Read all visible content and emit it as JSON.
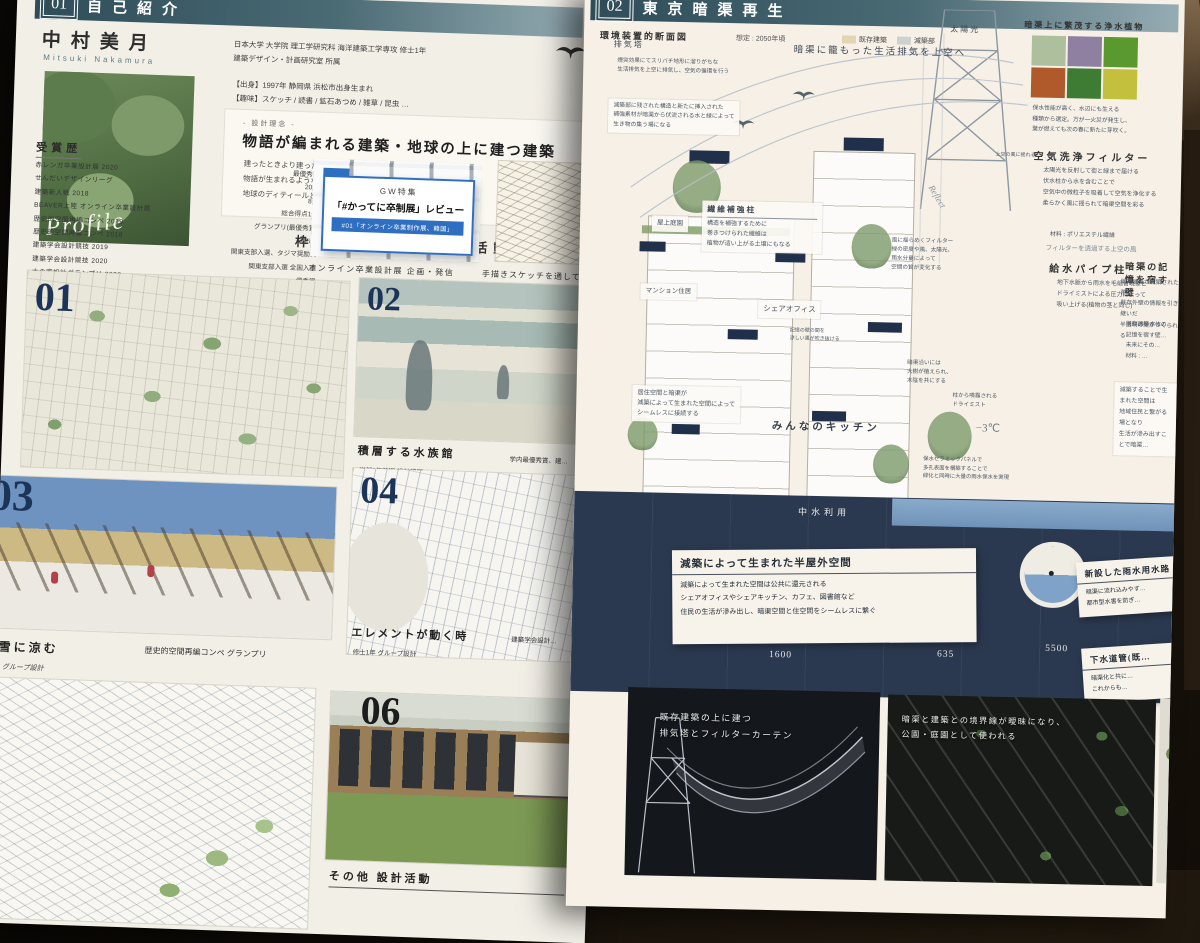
{
  "colors": {
    "header_teal": "#3a5863",
    "accent_blue": "#2f6fc2",
    "navy": "#2b3950",
    "paper": "#f2efe7",
    "paper_pink": "#f7f0e7"
  },
  "left_board": {
    "header": {
      "num": "01",
      "title": "自己紹介"
    },
    "profile": {
      "name": "中村美月",
      "romaji": "Mitsuki Nakamura",
      "photo_script": "Profile",
      "edu1": "日本大学 大学院 理工学研究科 海洋建築工学専攻 修士1年",
      "edu2": "建築デザイン・計画研究室 所属",
      "origin": "【出身】1997年 静岡県 浜松市出身生まれ",
      "hobby": "【趣味】スケッチ / 読書 / 鉱石あつめ / 雑草 / 昆虫 …"
    },
    "philosophy": {
      "tag": "- 設計理念 -",
      "title": "物語が編まれる建築・地球の上に建つ建築",
      "body": "建ったときより建ったあと、長く人々に愛され、\n物語が生まれるような建築をつくりたい。\n地球のディティールとしてたち現れる建築をつくりたい。"
    },
    "activities_heading": "枠に囚われない 設計活動",
    "awards": {
      "title": "受賞歴",
      "rows": [
        {
          "name": "赤レンガ卒業設計展 2020",
          "result": "最優秀賞"
        },
        {
          "name": "せんだいデザインリーグ",
          "result": "20選"
        },
        {
          "name": "建築新人戦 2018",
          "result": "8選"
        },
        {
          "name": "BEAVER上陸 オンライン卒業設計展",
          "result": "総合得点1位"
        },
        {
          "name": "歴史的空間再編コンペ 2019",
          "result": "グランプリ(最優秀賞)"
        },
        {
          "name": "歴史的空間再編コンペ 2018",
          "result": "第5位"
        },
        {
          "name": "建築学会設計競技 2019",
          "result": "関東支部入選、タジマ奨励賞"
        },
        {
          "name": "建築学会設計競技 2020",
          "result": "関東支部入選 全国入選"
        },
        {
          "name": "木の家設計グランプリ 2020",
          "result": "優秀賞"
        },
        {
          "name": "学内設計課題",
          "result": "最優秀賞8作品 優秀賞1作品"
        },
        {
          "name": "学部卒業時",
          "result": "優等賞(GPA上位3%)・桜工賞(大学貢献)"
        }
      ]
    },
    "feature": {
      "tag": "GW特集",
      "title": "「#かってに卒制展」レビュー",
      "badge": "#01「オンライン卒業制作展、韓国」",
      "caption_collage": "オンライン卒業設計展 企画・発信",
      "caption_sketch": "手描きスケッチを通して…"
    },
    "projects": {
      "p01": {
        "num": "01",
        "title": "東京暗渠再生",
        "meta": "学部4年 卒業設計",
        "award": "学内優秀賞、赤レンガ卒業設計展 グランプリ 他"
      },
      "p02": {
        "num": "02",
        "title": "積層する水族館",
        "meta": "学部3年前期 設計課題",
        "award": "学内最優秀賞、建…"
      },
      "p03": {
        "num": "03",
        "title": "雪に涼む",
        "meta": "グループ設計",
        "award": "歴史的空間再編コンペ グランプリ"
      },
      "p04": {
        "num": "04",
        "title": "エレメントが動く時",
        "meta": "修士1年 グループ設計",
        "award": "建築学会設計…"
      },
      "p06": {
        "num": "06",
        "title": "その他 設計活動"
      }
    }
  },
  "right_board": {
    "header": {
      "num": "02",
      "title": "東京暗渠再生"
    },
    "sub": {
      "label": "環境装置的断面図",
      "note": "想定 : 2050年頃",
      "legend": [
        {
          "label": "既存建築",
          "c": "#e3d5b4"
        },
        {
          "label": "減築部",
          "c": "#cdd2cf"
        }
      ]
    },
    "column": {
      "plants_title": "暗渠上に繁茂する浄水植物",
      "plants": [
        {
          "c": "#aebf9e"
        },
        {
          "c": "#8f7fa0"
        },
        {
          "c": "#59992f"
        },
        {
          "c": "#b05a2b"
        },
        {
          "c": "#3f7c33"
        },
        {
          "c": "#c2c03c"
        }
      ],
      "plants_note": "保水性能が高く、水辺にも生える\n種類から選定。万が一火災が発生し、\n葉が燃えても次の春に新たに芽吹く。",
      "filter_small": "上空の風に揺れる",
      "filter_title": "空気洗浄フィルター",
      "filter_lines": "太陽光を反射して街と緑まで届ける\n伏水柱から水を含むことで\n空気中の微粒子を吸着して空気を浄化する\n柔らかく風に揺られて暗渠空間を彩る",
      "filter_material": "材料 : ポリエステル繊維",
      "filter_wind": "フィルターを透過する上空の風",
      "pipe_title": "給水パイプ柱",
      "pipe_lines": "地下水脈から雨水を毛細管現象と\nドライミストによる圧力によって\n吸い上げる(植物の茎と同じ)",
      "memory_title": "暗渠の記憶を宿す壁",
      "memory_lines": "既存建築が減築された際、\n既存外壁の情報を引き継いだ\n半透明の壁がつくられる",
      "memory_lines2": "既存建築本体の…\n記憶を宿す壁…\n未来にその…\n材料 : …",
      "community": "減築することで生まれた空間は\n地域住民と繋がる場となり\n生活が滲み出すことで暗渠…"
    },
    "annotations": [
      {
        "t": "太陽光",
        "x": 366,
        "y": 30,
        "fs": 8,
        "cls": "strong"
      },
      {
        "t": "排気塔",
        "x": 30,
        "y": 52,
        "fs": 8,
        "cls": "strong"
      },
      {
        "t": "煙突効果にてスリバチ地形に溜りがちな\n生活排気を上空に排気し、空気の循環を行う",
        "x": 34,
        "y": 70,
        "fs": 5.6
      },
      {
        "t": "暗渠に籠もった生活排気を上空へ",
        "x": 210,
        "y": 52,
        "fs": 9.5,
        "cls": "strong"
      },
      {
        "t": "減築部に残された構造と新たに挿入された\n補強素材が暗渠から伏流される水と緑によって\n生き物の集う場になる",
        "x": 26,
        "y": 112,
        "fs": 5.8,
        "cls": "boxed"
      },
      {
        "h": "繊維補強柱",
        "t": "構造を補強するために\n巻きつけられた繊維は\n植物が這い上がる土壌にもなる",
        "x": 122,
        "y": 212,
        "fs": 6,
        "w": 110,
        "cls": "boxed"
      },
      {
        "t": "屋上庭園",
        "x": 72,
        "y": 228,
        "fs": 6.5,
        "cls": "boxed"
      },
      {
        "t": "マンション住居",
        "x": 62,
        "y": 296,
        "fs": 6.5,
        "cls": "boxed"
      },
      {
        "t": "シェアオフィス",
        "x": 180,
        "y": 310,
        "fs": 7.5,
        "cls": "boxed"
      },
      {
        "t": "みんなのキッチン",
        "x": 196,
        "y": 428,
        "fs": 10.5,
        "cls": "hand"
      },
      {
        "t": "居住空間と暗渠が\n減築によって生まれた空間によって\nシームレスに接続する",
        "x": 56,
        "y": 398,
        "fs": 6.2,
        "cls": "boxed"
      },
      {
        "t": "記憶の壁の間を\n涼しい風が吹き抜ける",
        "x": 212,
        "y": 336,
        "fs": 5
      },
      {
        "t": "風に揺らめくフィルター\n緑の密度や風、太陽光、\n雨水分量によって\n空間の質が変化する",
        "x": 312,
        "y": 244,
        "fs": 5.6
      },
      {
        "t": "Reflect",
        "x": 344,
        "y": 196,
        "fs": 9,
        "cls": "script",
        "rot": 58
      },
      {
        "t": "暗渠沿いには\n大樹が植えられ、\n木陰を共にする",
        "x": 330,
        "y": 366,
        "fs": 5.6
      },
      {
        "t": "柱から噴霧される\nドライミスト",
        "x": 376,
        "y": 398,
        "fs": 5.6
      },
      {
        "t": "−3℃",
        "x": 400,
        "y": 426,
        "fs": 11,
        "cls": "temp"
      },
      {
        "t": "保水セラミックパネルで\n多孔表面を構築することで\n緑化と同時に大量の雨水保水を実現",
        "x": 348,
        "y": 462,
        "fs": 5.4
      },
      {
        "t": "中水利用",
        "x": 224,
        "y": 514,
        "fs": 9,
        "cls": "onnavy"
      }
    ],
    "dims": [
      {
        "t": "1600",
        "x": 198,
        "y": 660
      },
      {
        "t": "635",
        "x": 366,
        "y": 656
      },
      {
        "t": "5500",
        "x": 474,
        "y": 648
      }
    ],
    "water": {
      "halfoutdoor_title": "減築によって生まれた半屋外空間",
      "halfoutdoor_lines": "減築によって生まれた空間は公共に還元される\nシェアオフィスやシェアキッチン、カフェ、図書館など\n住民の生活が滲み出し、暗渠空間と住空間をシームレスに繋ぐ",
      "box1_title": "新設した雨水用水路",
      "box1_lines": "暗渠に流れ込みやす…\n都市型水害を防ぎ…",
      "box2_title": "下水道管(既…",
      "box2_lines": "暗渠化と共に…\nこれからも…"
    },
    "renders": [
      {
        "caption": "既存建築の上に建つ\n排気塔とフィルターカーテン"
      },
      {
        "caption": "暗渠と建築との境界線が曖昧になり、\n公園・庭園として使われる"
      }
    ]
  }
}
